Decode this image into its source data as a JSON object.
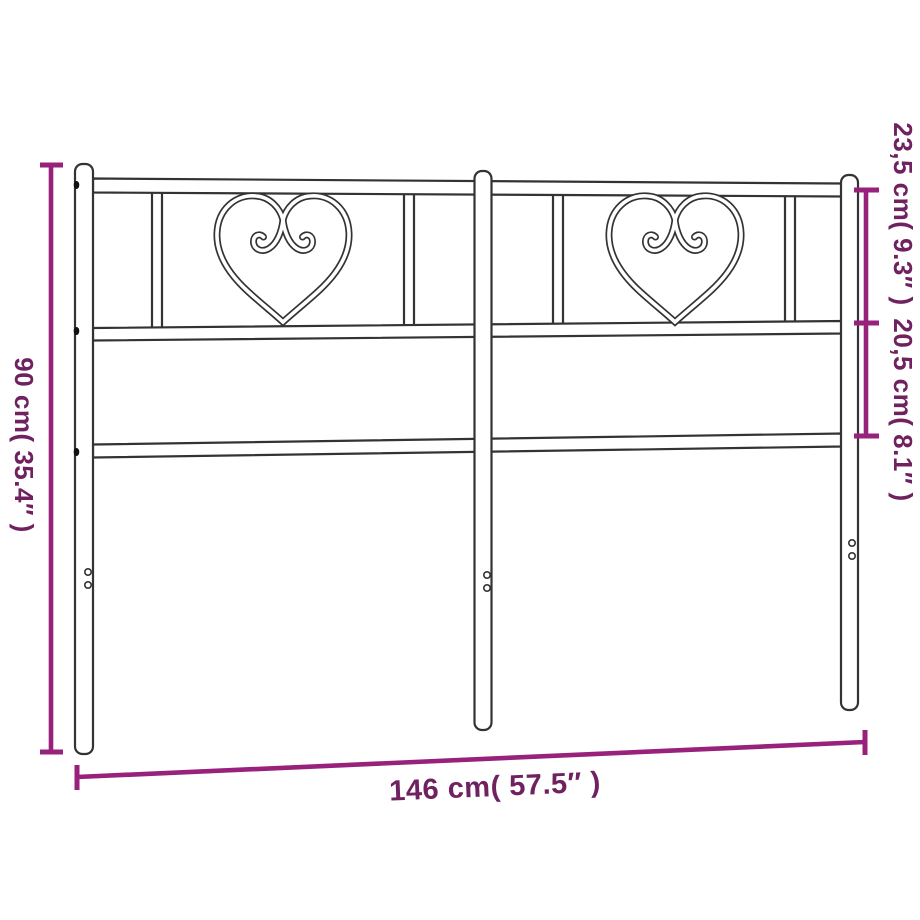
{
  "page": {
    "title": "Metal headboard with heart ornaments — dimension diagram",
    "background": "#ffffff"
  },
  "diagram": {
    "product": "metal-headboard-with-heart-ornaments",
    "style": {
      "frame_stroke_color": "#333333",
      "dimension_line_color": "#98217c",
      "dimension_text_color": "#6f2160"
    },
    "icons": {
      "heart_ornament": "heart-with-scroll-curls"
    },
    "dimensions": {
      "height": {
        "label": "90 cm( 35.4″ )",
        "orientation": "vertical-left"
      },
      "top_section": {
        "label": "23,5 cm( 9.3″ )",
        "orientation": "vertical-right"
      },
      "middle_section": {
        "label": "20,5 cm( 8.1″ )",
        "orientation": "vertical-right"
      },
      "width": {
        "label": "146 cm( 57.5″ )",
        "orientation": "horizontal-bottom"
      }
    }
  }
}
